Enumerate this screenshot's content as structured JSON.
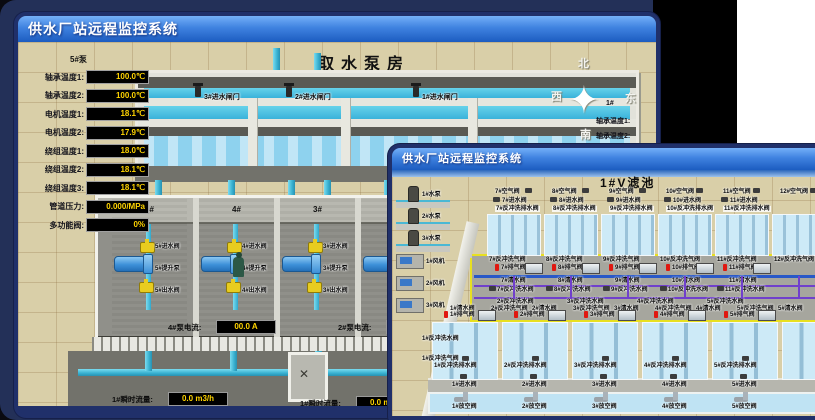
{
  "colors": {
    "desktop": "#233058",
    "titlebar_top": "#74b0f8",
    "titlebar_bottom": "#1c5cc0",
    "value_text": "#ffd400",
    "sand": "#d9cfa8",
    "water": "#3ab2da",
    "alarm_red": "#e01810"
  },
  "window_pump": {
    "title": "供水厂站远程监控系统",
    "scene_title": "取水泵房",
    "panel": {
      "header": "5#泵",
      "rows": [
        {
          "label": "轴承温度1:",
          "value": "100.0℃"
        },
        {
          "label": "轴承温度2:",
          "value": "100.0℃"
        },
        {
          "label": "电机温度1:",
          "value": "18.1℃"
        },
        {
          "label": "电机温度2:",
          "value": "17.9℃"
        },
        {
          "label": "绕组温度1:",
          "value": "18.0℃"
        },
        {
          "label": "绕组温度2:",
          "value": "18.1℃"
        },
        {
          "label": "绕组温度3:",
          "value": "18.1℃"
        },
        {
          "label": "管道压力:",
          "value": "0.000/MPa"
        },
        {
          "label": "多功能阀:",
          "value": "0%"
        }
      ]
    },
    "gates": [
      "3#进水闸门",
      "2#进水闸门",
      "1#进水闸门"
    ],
    "bays": [
      {
        "no": "5#",
        "inlet": "5#进水阀",
        "pump": "5#提升泵",
        "outlet": "5#出水阀"
      },
      {
        "no": "4#",
        "inlet": "4#进水阀",
        "pump": "4#提升泵",
        "outlet": "4#出水阀"
      },
      {
        "no": "3#",
        "inlet": "3#进水阀",
        "pump": "3#提升泵",
        "outlet": "3#出水阀"
      },
      {
        "no": "2#",
        "inlet": "2#进水阀",
        "pump": "2#提升泵",
        "outlet": "2#出水阀"
      }
    ],
    "current_meters": [
      {
        "label": "4#泵电流:",
        "value": "00.0 A"
      },
      {
        "label": "2#泵电流:",
        "value": "00.0 A"
      }
    ],
    "flow_meters": [
      {
        "label": "1#瞬时流量:",
        "value": "0.0 m3/h"
      },
      {
        "label": "1#瞬时流量:",
        "value": "0.0 m3/h"
      }
    ],
    "compass": {
      "north": "北",
      "west": "西",
      "south": "南",
      "east": "东"
    },
    "side_panel": {
      "header": "1#",
      "labels": [
        "轴承温度1:",
        "轴承温度2:"
      ]
    }
  },
  "window_filter": {
    "title": "供水厂站远程监控系统",
    "scene_title": "1#V滤池",
    "pumps": [
      "1#水泵",
      "2#水泵",
      "3#水泵"
    ],
    "fans": [
      "1#风机",
      "2#风机",
      "3#风机"
    ],
    "left_labels": [
      "1#反冲洗水阀",
      "1#反冲洗气阀"
    ],
    "top_cells": [
      {
        "air": "7#空气阀",
        "inlet": "7#进水阀",
        "drain": "7#反冲洗排水阀"
      },
      {
        "air": "8#空气阀",
        "inlet": "8#进水阀",
        "drain": "8#反冲洗排水阀"
      },
      {
        "air": "9#空气阀",
        "inlet": "9#进水阀",
        "drain": "9#反冲洗排水阀"
      },
      {
        "air": "10#空气阀",
        "inlet": "10#进水阀",
        "drain": "10#反冲洗排水阀"
      },
      {
        "air": "11#空气阀",
        "inlet": "11#进水阀",
        "drain": "11#反冲洗排水阀"
      },
      {
        "air": "12#空气阀",
        "inlet": "",
        "drain": ""
      }
    ],
    "gallery_top_air": [
      "7#反冲洗气阀",
      "8#反冲洗气阀",
      "9#反冲洗气阀",
      "10#反冲洗气阀",
      "11#反冲洗气阀",
      "12#反冲洗气阀"
    ],
    "gallery_top_vent": [
      "7#排气阀",
      "8#排气阀",
      "9#排气阀",
      "10#排气阀",
      "11#排气阀"
    ],
    "gallery_top_clean": [
      "7#清水阀",
      "8#清水阀",
      "9#清水阀",
      "10#清水阀",
      "11#清水阀"
    ],
    "gallery_mid_backwash": [
      "7#反冲洗水阀",
      "8#反冲洗水阀",
      "9#反冲洗水阀",
      "10#反冲洗水阀",
      "11#反冲洗水阀"
    ],
    "gallery_low_backwash": [
      "2#反冲洗水阀",
      "3#反冲洗水阀",
      "4#反冲洗水阀",
      "5#反冲洗水阀"
    ],
    "gallery_bottom_mixed": [
      "1#清水阀",
      "2#反冲洗气阀",
      "2#清水阀",
      "3#反冲洗气阀",
      "3#清水阀",
      "4#反冲洗气阀",
      "4#清水阀",
      "5#反冲洗气阀",
      "5#清水阀"
    ],
    "gallery_bottom_vent": [
      "1#排气阀",
      "2#排气阀",
      "3#排气阀",
      "4#排气阀",
      "5#排气阀"
    ],
    "bottom_cells": [
      {
        "drain": "1#反冲洗排水阀",
        "inlet": "1#进水阀",
        "empty": "1#放空阀"
      },
      {
        "drain": "2#反冲洗排水阀",
        "inlet": "2#进水阀",
        "empty": "2#放空阀"
      },
      {
        "drain": "3#反冲洗排水阀",
        "inlet": "3#进水阀",
        "empty": "3#放空阀"
      },
      {
        "drain": "4#反冲洗排水阀",
        "inlet": "4#进水阀",
        "empty": "4#放空阀"
      },
      {
        "drain": "5#反冲洗排水阀",
        "inlet": "5#进水阀",
        "empty": "5#放空阀"
      }
    ]
  }
}
